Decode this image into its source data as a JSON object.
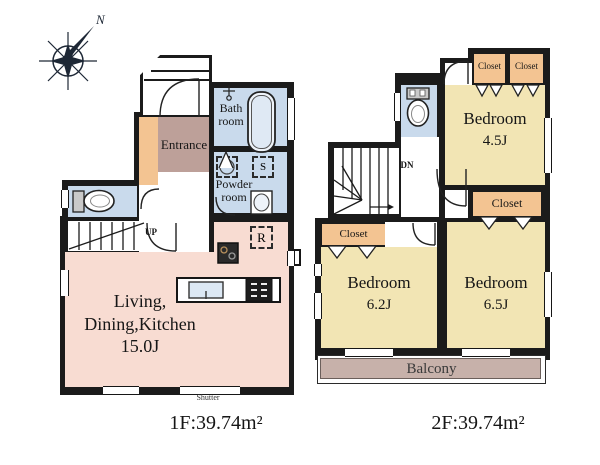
{
  "compass": {
    "north_label": "N"
  },
  "colors": {
    "wall": "#1b1b1b",
    "ldk_floor": "#f8dcd2",
    "bedroom_floor": "#f2e5b4",
    "closet_fill": "#f3c492",
    "entrance_fill": "#bda099",
    "wet_room_fill": "#c9daec",
    "balcony_fill": "#c7b1aa"
  },
  "floor1": {
    "caption": "1F:39.74m²",
    "entrance_label": "Entrance",
    "bathroom_label_line1": "Bath",
    "bathroom_label_line2": "room",
    "powder_label_line1": "Powder",
    "powder_label_line2": "room",
    "ldk_label_line1": "Living,",
    "ldk_label_line2": "Dining,Kitchen",
    "ldk_label_line3": "15.0J",
    "stairs_label": "UP",
    "refrigerator_label": "R",
    "storage_label": "S",
    "shutter_label": "Shutter"
  },
  "floor2": {
    "caption": "2F:39.74m²",
    "stairs_label": "DN",
    "bedroom_45": {
      "name": "Bedroom",
      "size": "4.5J"
    },
    "bedroom_62": {
      "name": "Bedroom",
      "size": "6.2J"
    },
    "bedroom_65": {
      "name": "Bedroom",
      "size": "6.5J"
    },
    "closets": {
      "top_left": "Closet",
      "top_right": "Closet",
      "middle": "Closet",
      "bedroom62": "Closet"
    },
    "balcony_label": "Balcony"
  }
}
